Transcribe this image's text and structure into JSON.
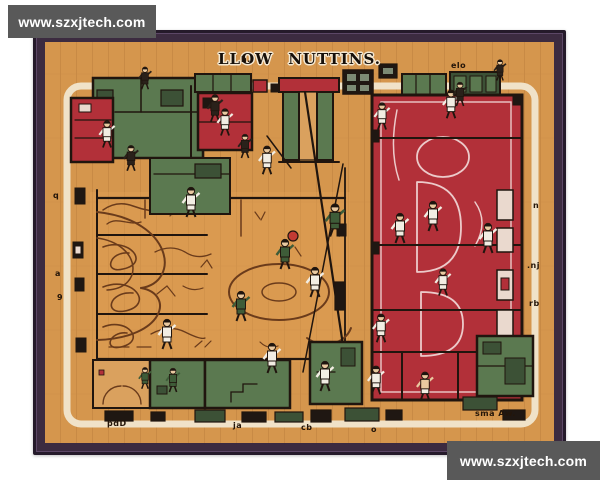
{
  "artwork": {
    "title": "LLOW NUTTINS."
  },
  "watermarks": {
    "top_left": "www.szxjtech.com",
    "bottom_right": "www.szxjtech.com"
  },
  "colors": {
    "page_bg": "#ffffff",
    "frame": "#3c2b40",
    "frame_edge": "#251a2a",
    "wood": "#d5964d",
    "wood_dark": "#b87c3b",
    "cream": "#f0e2c8",
    "red": "#b23039",
    "green": "#5b7950",
    "green_dark": "#3c5136",
    "ink": "#20150e",
    "court_line": "#6a3b1b",
    "pink_line": "#eccaca",
    "jersey_white": "#f2ede3",
    "jersey_green": "#3e5c38",
    "skin": "#e9c9a0",
    "figure_dark": "#2a211a",
    "ball": "#c23b33",
    "watermark_bg": "#595959",
    "watermark_text": "#ffffff"
  },
  "scene": {
    "figures": [
      {
        "x": 170,
        "y": 66,
        "j": "dark",
        "s": 0.9
      },
      {
        "x": 62,
        "y": 92,
        "j": "white",
        "s": 0.9
      },
      {
        "x": 86,
        "y": 116,
        "j": "dark",
        "s": 0.85
      },
      {
        "x": 146,
        "y": 160,
        "j": "white"
      },
      {
        "x": 222,
        "y": 118,
        "j": "white",
        "s": 0.95
      },
      {
        "x": 200,
        "y": 104,
        "j": "dark",
        "s": 0.8
      },
      {
        "x": 180,
        "y": 80,
        "j": "white",
        "s": 0.9
      },
      {
        "x": 240,
        "y": 212,
        "j": "green"
      },
      {
        "x": 290,
        "y": 178,
        "j": "green",
        "s": 1.1
      },
      {
        "x": 270,
        "y": 240,
        "j": "white"
      },
      {
        "x": 196,
        "y": 264,
        "j": "green"
      },
      {
        "x": 122,
        "y": 292,
        "j": "white"
      },
      {
        "x": 227,
        "y": 316,
        "j": "white"
      },
      {
        "x": 337,
        "y": 74,
        "j": "white",
        "s": 0.9
      },
      {
        "x": 406,
        "y": 62,
        "j": "white",
        "s": 0.95
      },
      {
        "x": 355,
        "y": 186,
        "j": "white"
      },
      {
        "x": 388,
        "y": 174,
        "j": "white"
      },
      {
        "x": 443,
        "y": 196,
        "j": "white"
      },
      {
        "x": 398,
        "y": 240,
        "j": "white",
        "s": 0.9
      },
      {
        "x": 336,
        "y": 286,
        "j": "white",
        "s": 0.95
      },
      {
        "x": 331,
        "y": 338,
        "j": "white",
        "s": 0.95
      },
      {
        "x": 380,
        "y": 344,
        "j": "skin",
        "s": 0.95
      },
      {
        "x": 280,
        "y": 334,
        "j": "white"
      },
      {
        "x": 128,
        "y": 338,
        "j": "green",
        "s": 0.8
      },
      {
        "x": 100,
        "y": 336,
        "j": "green",
        "s": 0.72
      },
      {
        "x": 415,
        "y": 52,
        "j": "dark",
        "s": 0.8
      },
      {
        "x": 455,
        "y": 28,
        "j": "dark",
        "s": 0.7
      },
      {
        "x": 100,
        "y": 36,
        "j": "dark",
        "s": 0.75
      }
    ],
    "marks": [
      {
        "text": "h.",
        "x": 196,
        "y": 14
      },
      {
        "text": "elo",
        "x": 406,
        "y": 20
      },
      {
        "text": "q",
        "x": 8,
        "y": 150
      },
      {
        "text": "a",
        "x": 10,
        "y": 228
      },
      {
        "text": "9",
        "x": 12,
        "y": 252
      },
      {
        "text": "n",
        "x": 488,
        "y": 160
      },
      {
        "text": ".nj",
        "x": 482,
        "y": 220
      },
      {
        "text": "rb",
        "x": 484,
        "y": 258
      },
      {
        "text": "pdD",
        "x": 62,
        "y": 378
      },
      {
        "text": "ja",
        "x": 188,
        "y": 380
      },
      {
        "text": "cb",
        "x": 256,
        "y": 382
      },
      {
        "text": "o",
        "x": 326,
        "y": 384
      },
      {
        "text": "sma Aw.",
        "x": 430,
        "y": 368
      }
    ]
  }
}
